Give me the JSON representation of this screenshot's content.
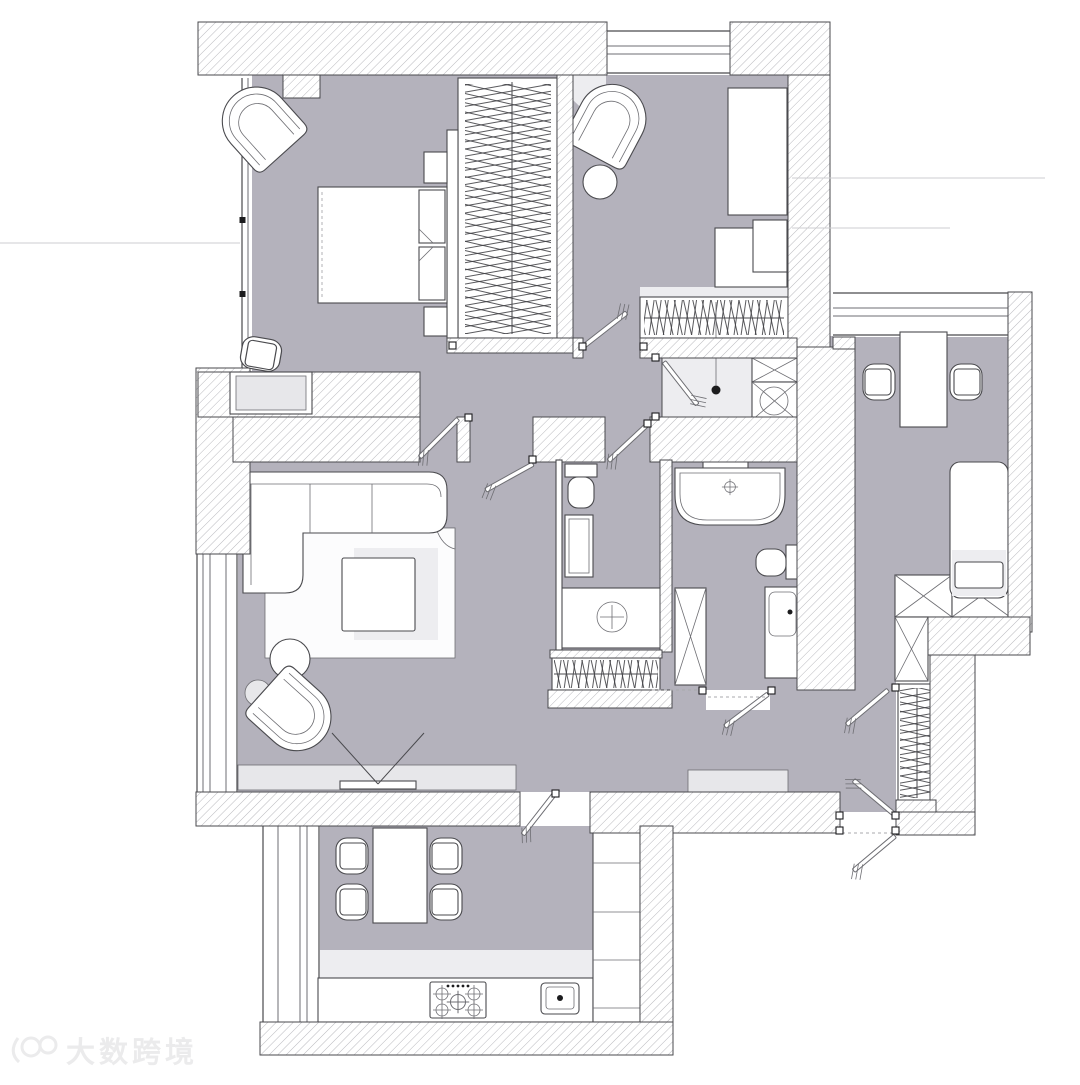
{
  "scene": {
    "type": "apartment-floor-plan",
    "style": "top-down architectural drawing, hatched walls, gray floors, white furniture symbols",
    "rooms": [
      {
        "name": "bedroom",
        "furniture": [
          "double-bed",
          "nightstand",
          "nightstand",
          "corner-armchair",
          "desk-nook-chair",
          "walk-in-wardrobe"
        ]
      },
      {
        "name": "kids-room",
        "furniture": [
          "armchair",
          "round-side-table",
          "bed",
          "desk-with-chair",
          "wardrobe-with-hangers"
        ]
      },
      {
        "name": "office-guest-room",
        "furniture": [
          "desk",
          "two-chairs",
          "single-bed",
          "x-wardrobe"
        ]
      },
      {
        "name": "living-room",
        "furniture": [
          "corner-sofa",
          "rug",
          "square-coffee-table",
          "round-side-tables",
          "armchair",
          "tv-console",
          "tv"
        ]
      },
      {
        "name": "kitchen-dining",
        "furniture": [
          "dining-table",
          "four-chairs",
          "counter",
          "gas-hob",
          "sink",
          "tall-cabinets"
        ]
      },
      {
        "name": "shower-room",
        "furniture": [
          "shower-tray",
          "washing-machine",
          "storage-box"
        ]
      },
      {
        "name": "wc",
        "furniture": [
          "toilet",
          "tall-vanity",
          "washbasin-counter"
        ]
      },
      {
        "name": "bathroom",
        "furniture": [
          "freestanding-bathtub",
          "toilet",
          "tall-cabinet",
          "vanity-sink",
          "shelf-niche"
        ]
      },
      {
        "name": "hallway",
        "furniture": [
          "bench-console",
          "hanger-closet",
          "entry-double-door"
        ]
      }
    ]
  },
  "palette": {
    "floor": "#b4b2bc",
    "hatch": "#a2a2a8",
    "hanger": "#3c3c40",
    "line": "#4a4a4e",
    "soft": "#6e6e73",
    "white": "#ffffff",
    "shadow": "#e7e7ea",
    "shadow2": "#ededf0",
    "rug": "#fcfcfd",
    "refline": "#cdcdd0",
    "watermark": "#ebebec",
    "dark": "#1c1c1e"
  },
  "watermark": {
    "logo": "100",
    "text": "大数跨境"
  }
}
